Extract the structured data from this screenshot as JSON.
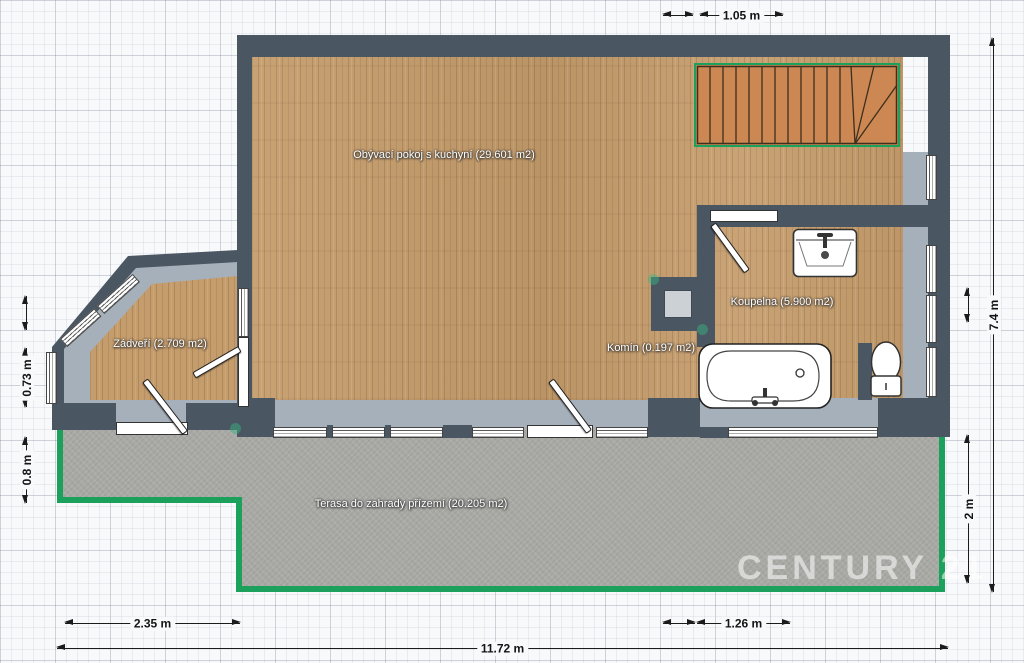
{
  "rooms": {
    "living": {
      "label": "Obývací pokoj s kuchyní (29.601 m2)"
    },
    "entry": {
      "label": "Zádveří (2.709 m2)"
    },
    "bathroom": {
      "label": "Koupelna (5.900 m2)"
    },
    "chimney": {
      "label": "Komín (0.197 m2)"
    },
    "terrace": {
      "label": "Terasa do zahrady přízemí (20.205 m2)"
    }
  },
  "dimensions": {
    "top_width": "1.05 m",
    "right_height_total": "7.4 m",
    "right_terrace_height": "2 m",
    "left_entry_upper": "0.73 m",
    "left_entry_lower": "0.8 m",
    "bottom_left_width": "2.35 m",
    "bottom_right_width": "1.26 m",
    "bottom_total_width": "11.72 m"
  },
  "watermark": "CENTURY 21",
  "fixtures": [
    "staircase",
    "chimney",
    "sink",
    "bathtub",
    "toilet"
  ],
  "colors": {
    "wall": "#4a5661",
    "floor_wood": "#c59c6b",
    "window_sill": "#a6b0ba",
    "terrace": "#a8a8a4",
    "terrace_border": "#1ca15c",
    "stairs": "#cd8752",
    "dimension_ink": "#1b1b1b"
  }
}
